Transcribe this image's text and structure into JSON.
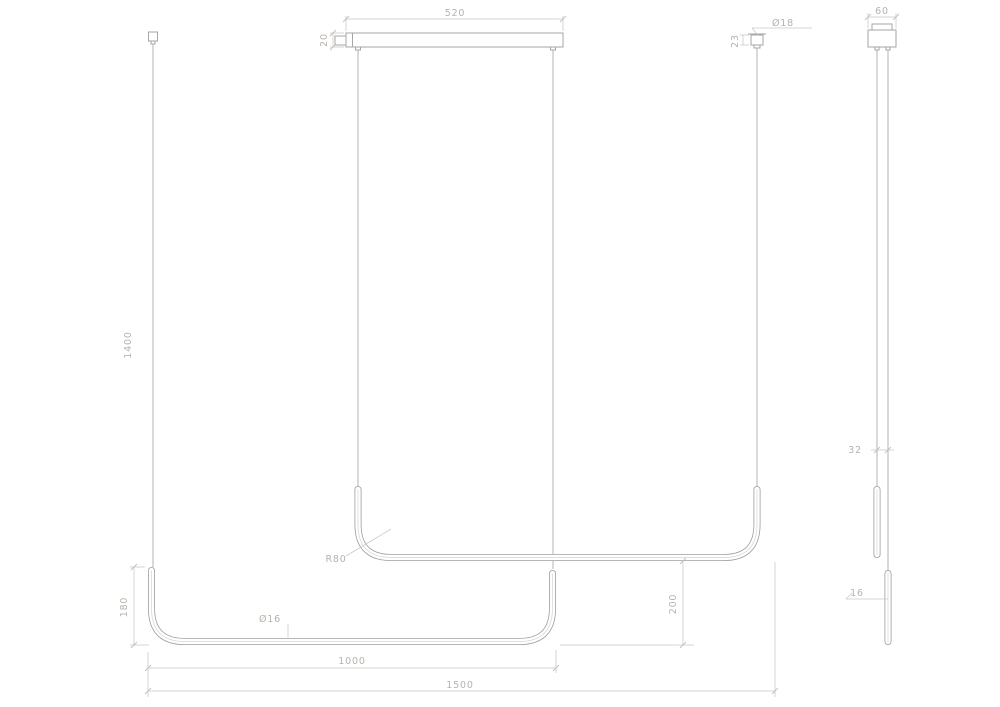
{
  "front_view": {
    "canopy_width": "520",
    "canopy_height": "20",
    "drop_height": "1400",
    "mount_diameter": "Ø18",
    "mount_height": "23",
    "bend_radius": "R80",
    "tube_diameter": "Ø16",
    "end_upturn_height": "180",
    "tube_vertical_offset": "200",
    "lamp_length": "1000",
    "total_width": "1500"
  },
  "side_view": {
    "canopy_width": "60",
    "tube_gap": "32",
    "tube_width": "16"
  },
  "colors": {
    "background": "#ffffff",
    "line": "#a6a6a6",
    "dimension": "#cbc7c1",
    "text": "#b7b2ab"
  }
}
